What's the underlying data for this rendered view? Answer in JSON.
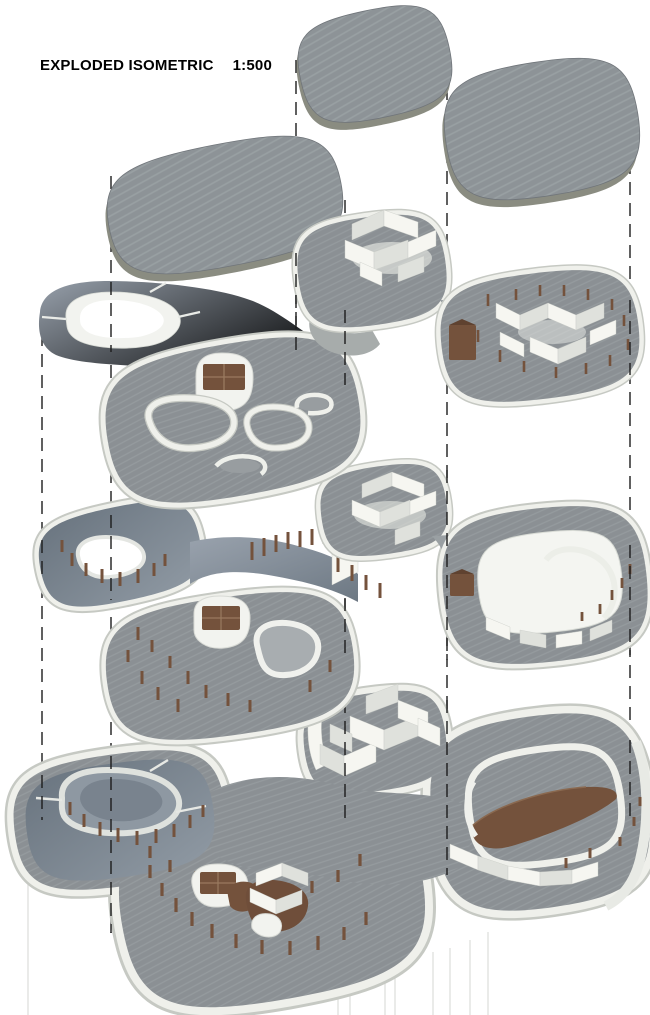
{
  "header": {
    "title": "EXPLODED ISOMETRIC",
    "scale": "1:500"
  },
  "drawing": {
    "kind": "exploded-isometric-architectural-model",
    "roof_slab_count": 3,
    "floor_plate_count": 4,
    "features": [
      "roof slabs",
      "courtyard rings",
      "spiral courtyard",
      "room partitions",
      "timber columns",
      "timber furniture",
      "entry ramp",
      "dashed projection lines"
    ]
  },
  "colors": {
    "background": "#ffffff",
    "title-text": "#000000",
    "roof-surface": "#8d9397",
    "roof-edge": "#8a8c81",
    "wall-white": "#eff0eb",
    "wall-shadow": "#c6c9c3",
    "floor-gray": "#8b9094",
    "deck-blue": "#76818d",
    "timber-brown": "#74523c",
    "dash-line": "#1c1c1c",
    "faint-line": "#d9dad7"
  }
}
